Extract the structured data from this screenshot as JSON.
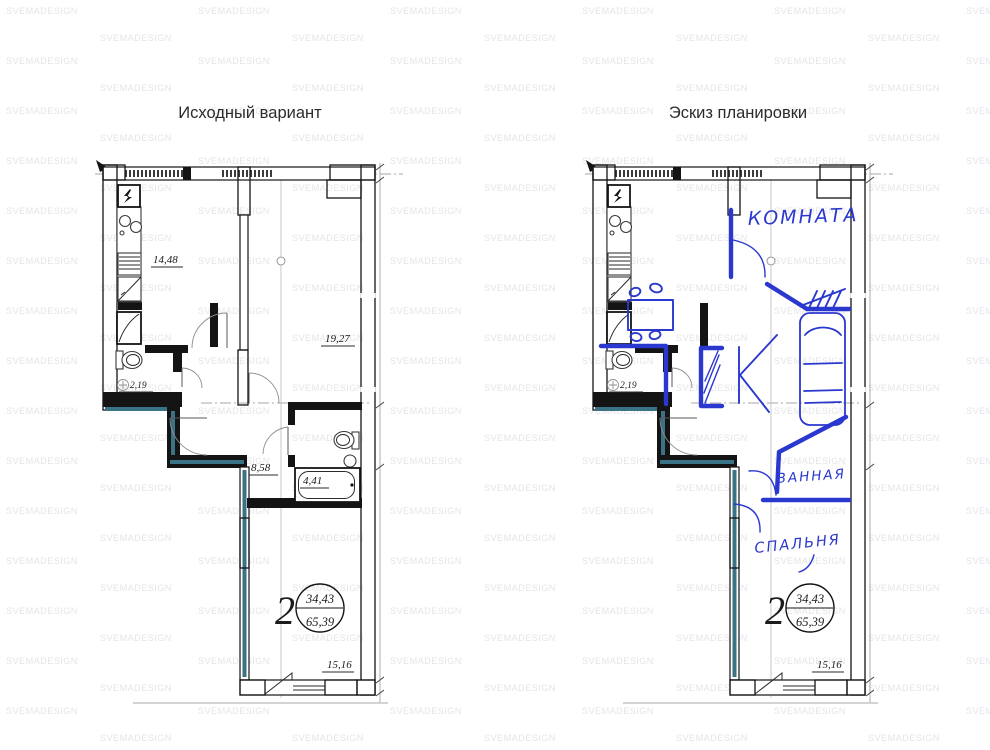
{
  "watermark": "SVEMADESIGN",
  "titles": {
    "left": "Исходный вариант",
    "right": "Эскиз планировки"
  },
  "plan": {
    "rooms_count": "2",
    "area_living_total": "34,43",
    "area_total": "65,39",
    "areas": {
      "kitchen": "14,48",
      "living_room": "19,27",
      "hallway": "8,58",
      "bathroom": "4,41",
      "wc": "2,19",
      "bedroom": "15,16"
    }
  },
  "sketch_annotations": {
    "room": "КОМНАТА",
    "bathroom": "ВАННАЯ",
    "bedroom": "СПАЛЬНЯ"
  },
  "colors": {
    "sketch-blue": "#2a38cf",
    "accent-teal": "#3b7386",
    "watermark-gray": "#e5e5e8",
    "dim-text": "#1c1c1c"
  }
}
